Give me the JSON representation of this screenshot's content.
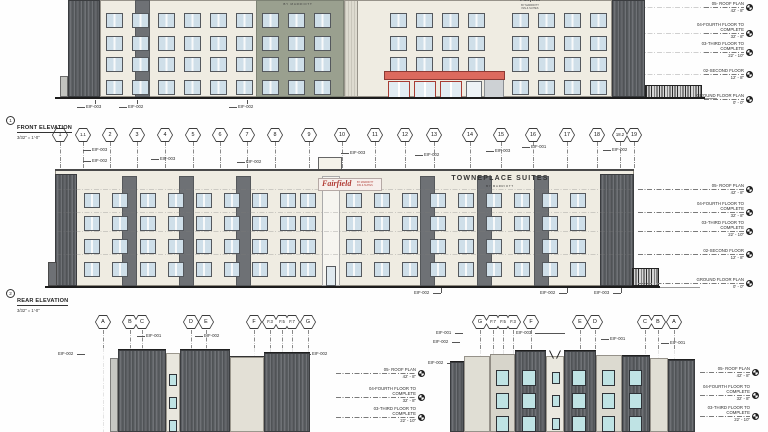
{
  "levels": [
    {
      "name": "05- ROOF PLAN",
      "elev": "42' - 8\""
    },
    {
      "name": "04-FOURTH FLOOR TO COMPLETE",
      "elev": "32' - 8\""
    },
    {
      "name": "03-THIRD FLOOR TO COMPLETE",
      "elev": "22' - 10\""
    },
    {
      "name": "02-SECOND FLOOR",
      "elev": "12' - 8\""
    },
    {
      "name": "GROUND FLOOR PLAN",
      "elev": "0' - 0\""
    }
  ],
  "front_elevation": {
    "number": "1",
    "title": "FRONT ELEVATION",
    "scale": "3/32\" = 1'-0\"",
    "sign_towneplace": {
      "line1": "TOWNEPLACE SUITES",
      "line2": "BY MARRIOTT"
    },
    "sign_fairfield": {
      "line1": "Fairfield",
      "line2": "BY MARRIOTT",
      "line3": "INN & SUITES"
    },
    "tags": [
      "EIF-003",
      "EIF-002",
      "EIF-002"
    ]
  },
  "rear_elevation": {
    "number": "2",
    "title": "REAR ELEVATION",
    "scale": "3/32\" = 1'-0\"",
    "grid_bubbles": [
      "1",
      "1.1",
      "2",
      "3",
      "4",
      "5",
      "6",
      "7",
      "8",
      "9",
      "10",
      "11",
      "12",
      "13",
      "14",
      "15",
      "16",
      "17",
      "18",
      "18.2",
      "19"
    ],
    "sign_fairfield": {
      "line1": "Fairfield",
      "line2": "BY MARRIOTT",
      "line3": "INN & SUITES"
    },
    "sign_towneplace": {
      "line1": "TOWNEPLACE SUITES",
      "line2": "BY MARRIOTT"
    },
    "tags_top": [
      "EIF-003",
      "EIF-002",
      "EIF-003",
      "EIF-002",
      "EIF-003",
      "EIF-002",
      "EIF-003",
      "EIF-001",
      "EIF-002"
    ],
    "tags_bottom": [
      "EIF-002",
      "EIF-002",
      "EIF-003"
    ]
  },
  "left_side_elevation": {
    "grid_bubbles": [
      "A",
      "B",
      "C",
      "D",
      "E",
      "F",
      "F.3",
      "F.5",
      "F.7",
      "G"
    ],
    "tags": [
      "EIF-002",
      "EIF-001",
      "EIF-002",
      "EIF-002"
    ]
  },
  "right_side_elevation": {
    "grid_bubbles": [
      "G",
      "F.7",
      "F.5",
      "F.3",
      "F",
      "E",
      "D",
      "C",
      "B",
      "A"
    ],
    "tags": [
      "EIF-001",
      "EIF-002",
      "EIF-002",
      "EIF-003",
      "EIF-001",
      "EIF-001"
    ]
  },
  "colors": {
    "accent_red": "#dc6a5e",
    "sign_red": "#b13c36",
    "glass_blue": "#cfdfe9",
    "glass_teal": "#bfe3e4",
    "siding_dark": "#5a5d61",
    "stucco_cream": "#efece2",
    "panel_sage": "#9aa08f"
  }
}
